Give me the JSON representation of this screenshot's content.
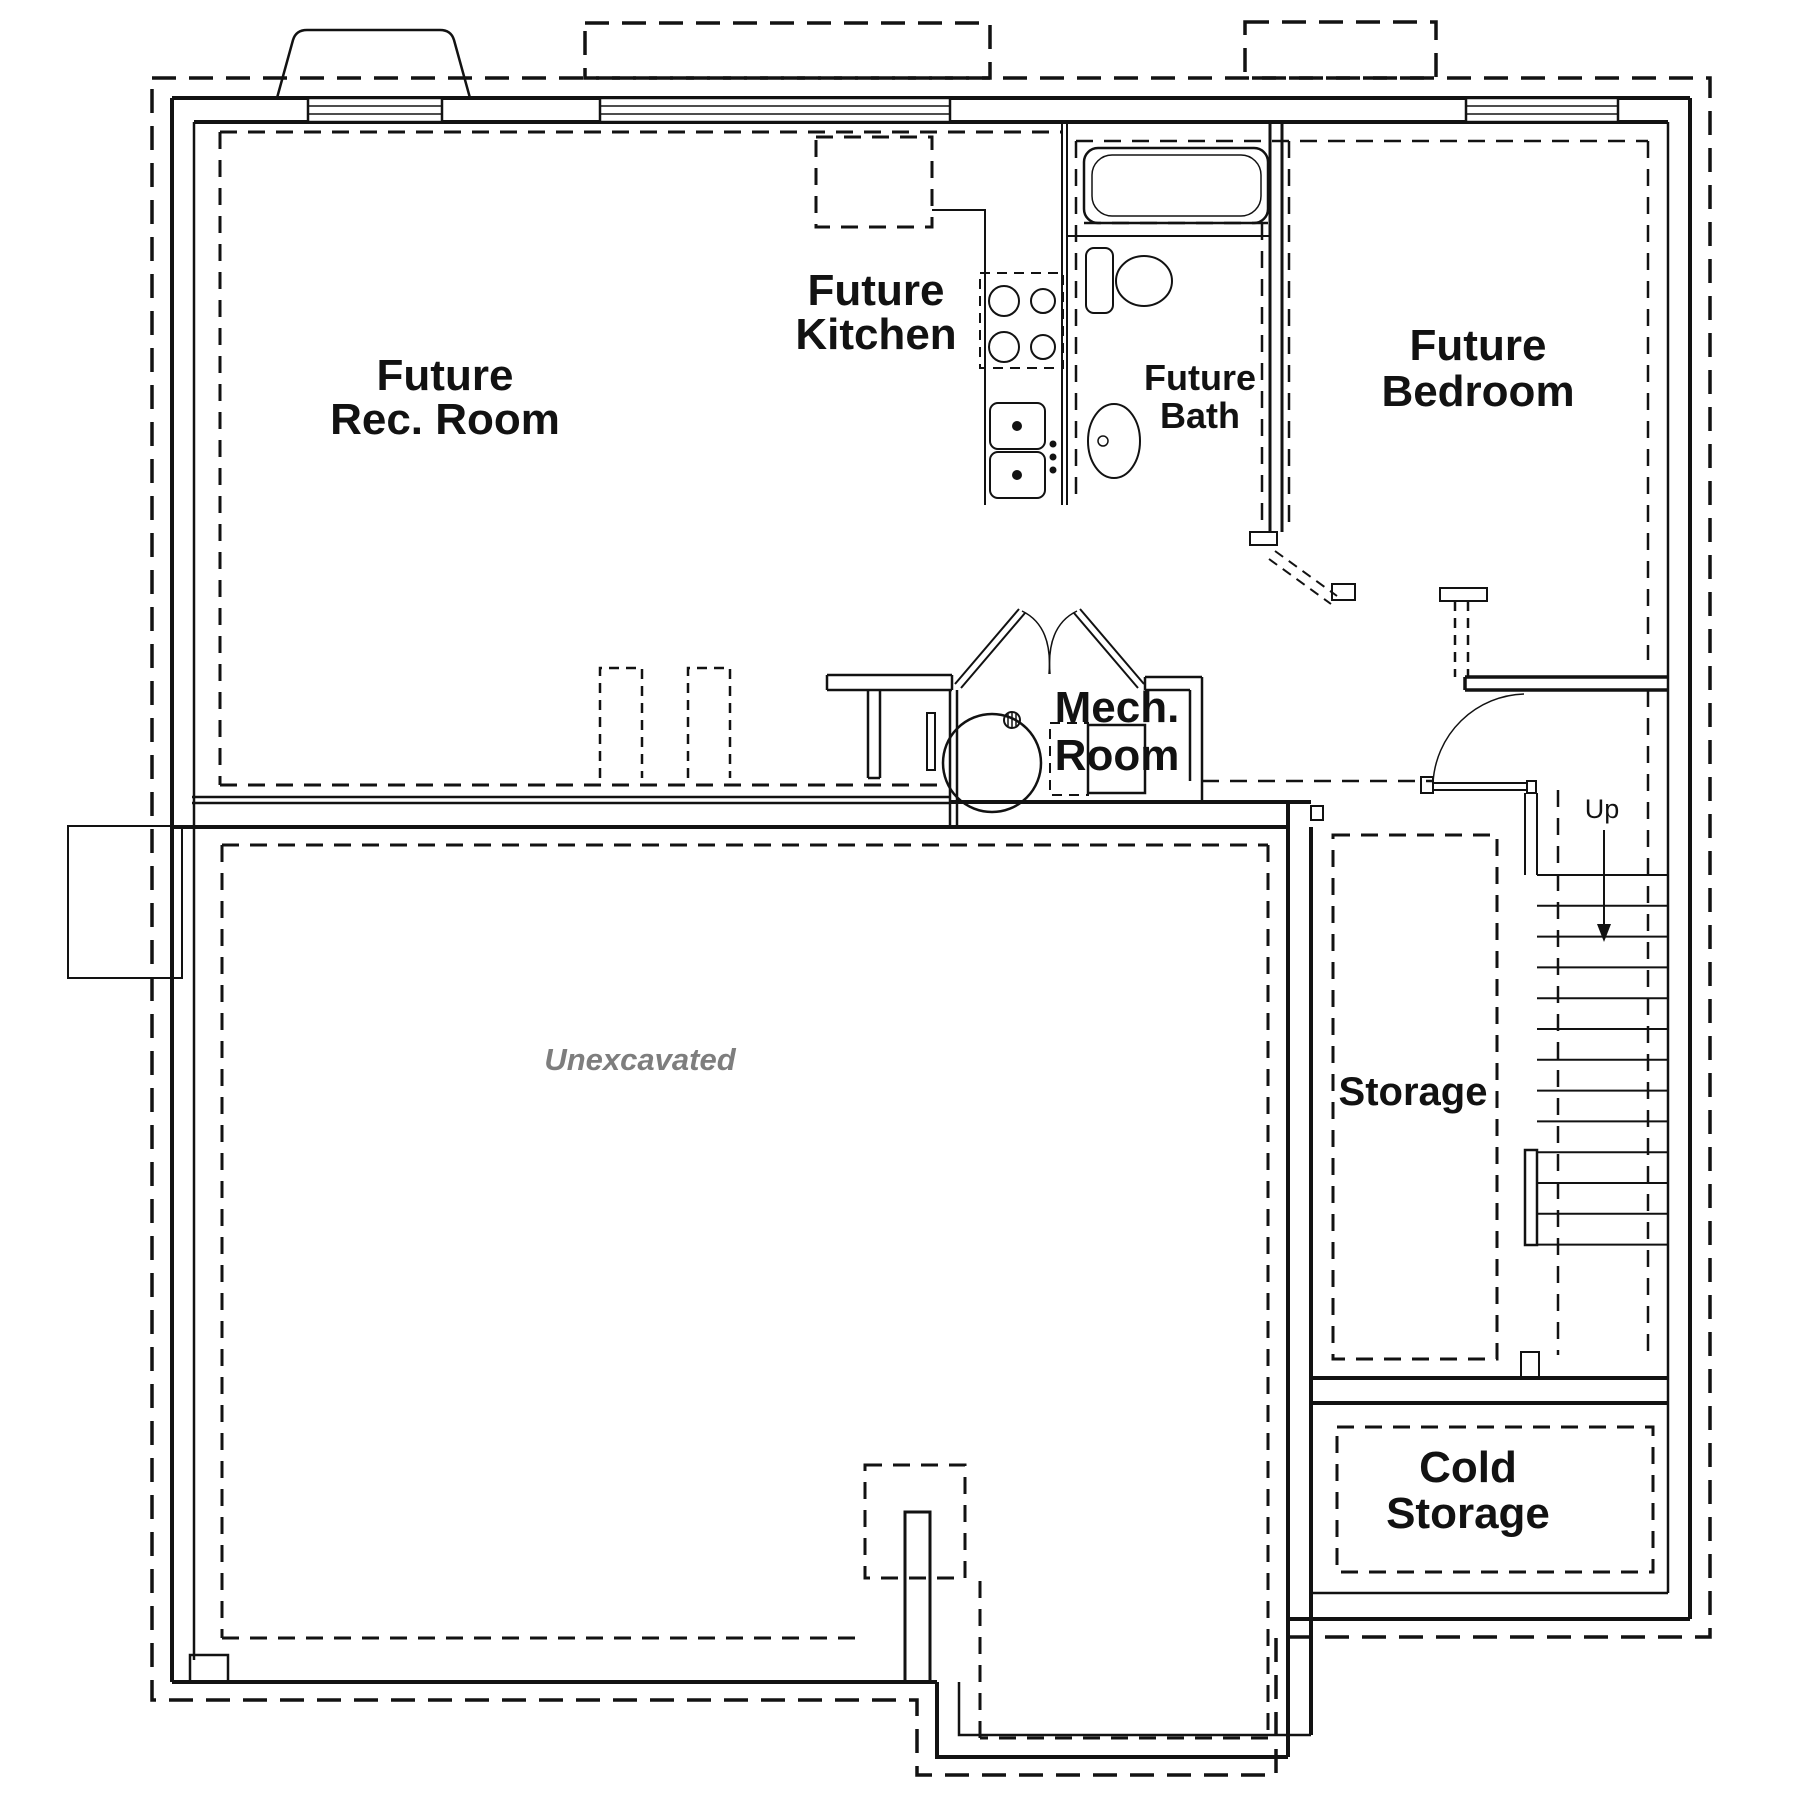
{
  "plan": {
    "type": "basement-floor-plan",
    "colors": {
      "line": "#121212",
      "unexcavated_text": "#7e7e7e",
      "background": "#ffffff"
    },
    "rooms": {
      "rec_room": {
        "label_line1": "Future",
        "label_line2": "Rec. Room"
      },
      "kitchen": {
        "label_line1": "Future",
        "label_line2": "Kitchen"
      },
      "bath": {
        "label_line1": "Future",
        "label_line2": "Bath"
      },
      "bedroom": {
        "label_line1": "Future",
        "label_line2": "Bedroom"
      },
      "mech_room": {
        "label_line1": "Mech.",
        "label_line2": "Room"
      },
      "storage": {
        "label": "Storage"
      },
      "cold_storage": {
        "label_line1": "Cold",
        "label_line2": "Storage"
      },
      "unexcavated": {
        "label": "Unexcavated"
      }
    },
    "stairs": {
      "label": "Up",
      "tread_count": 13,
      "tread_top_y": 875,
      "tread_spacing": 30.8,
      "tread_x1": 1537,
      "tread_x2": 1668
    },
    "fixtures": [
      "bathtub",
      "toilet",
      "bath-sink",
      "kitchen-sink",
      "cooktop",
      "kitchen-island",
      "water-heater",
      "furnace",
      "floor-drain",
      "window-wells",
      "windows"
    ]
  }
}
